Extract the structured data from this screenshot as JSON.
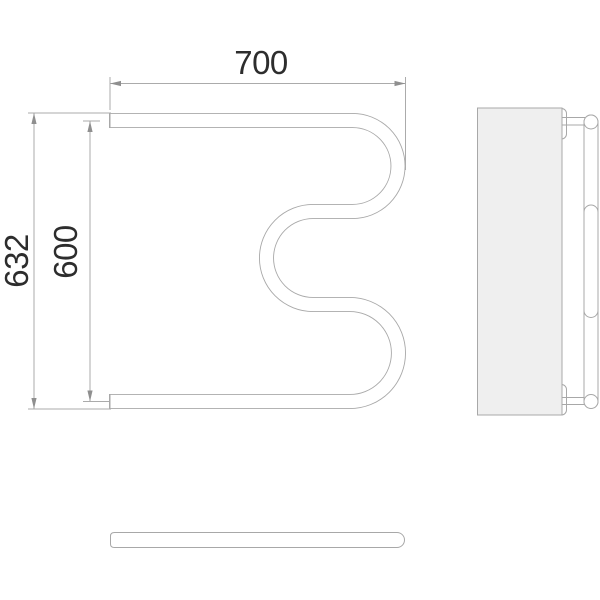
{
  "drawing": {
    "kind": "towel-rail-technical-drawing",
    "views": {
      "front": "m-shaped-tube-front-view",
      "side": "wall-plate-side-view",
      "bottom": "tube-bottom-view"
    },
    "dimensions": {
      "top_width": "700",
      "overall_height": "632",
      "center_height": "600"
    },
    "colors": {
      "background": "#ffffff",
      "line": "#a8a8a8",
      "dim": "#ababab",
      "arrow": "#8f8f8f",
      "text": "#2d2d2d",
      "plate": "#efefef",
      "fill": "#ffffff"
    }
  }
}
